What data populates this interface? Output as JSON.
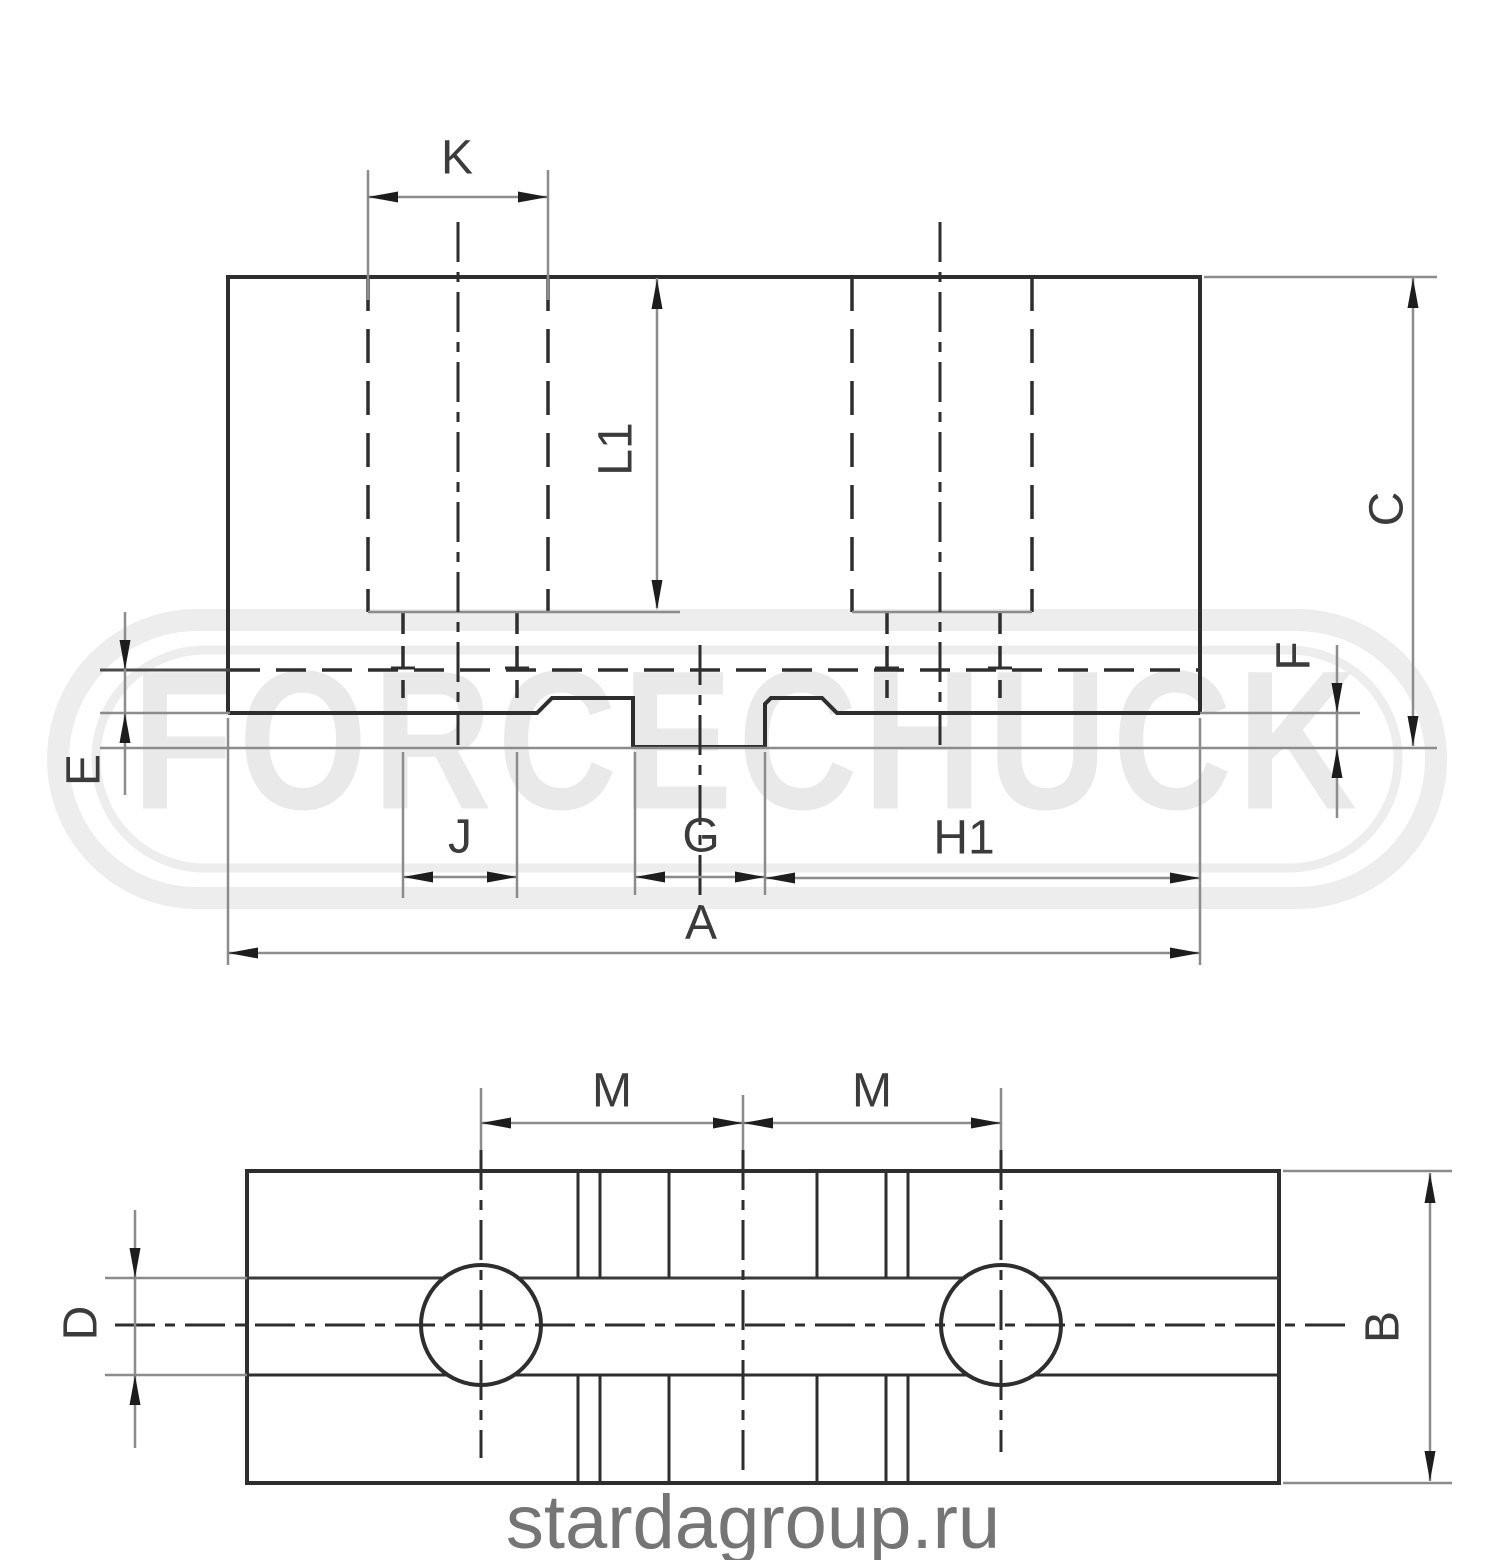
{
  "title": "Soft jaw technical drawing",
  "colors": {
    "background": "#ffffff",
    "main_line": "#2e2e2e",
    "thin_line": "#8c8c8c",
    "label": "#3b3b3b",
    "watermark": "#e9e9e9",
    "url_text": "#757575"
  },
  "watermark": {
    "text": "FORCECHUCK"
  },
  "footer": {
    "url": "stardagroup.ru"
  },
  "views": {
    "side_view": {
      "name": "side elevation (upper view)",
      "dimension_labels": {
        "k": "K",
        "l1": "L1",
        "c": "C",
        "e": "E",
        "f": "F",
        "j": "J",
        "g": "G",
        "h1": "H1",
        "a": "A"
      }
    },
    "plan_view": {
      "name": "plan view (lower view)",
      "dimension_labels": {
        "m_left": "M",
        "m_right": "M",
        "d": "D",
        "b": "B"
      }
    }
  }
}
